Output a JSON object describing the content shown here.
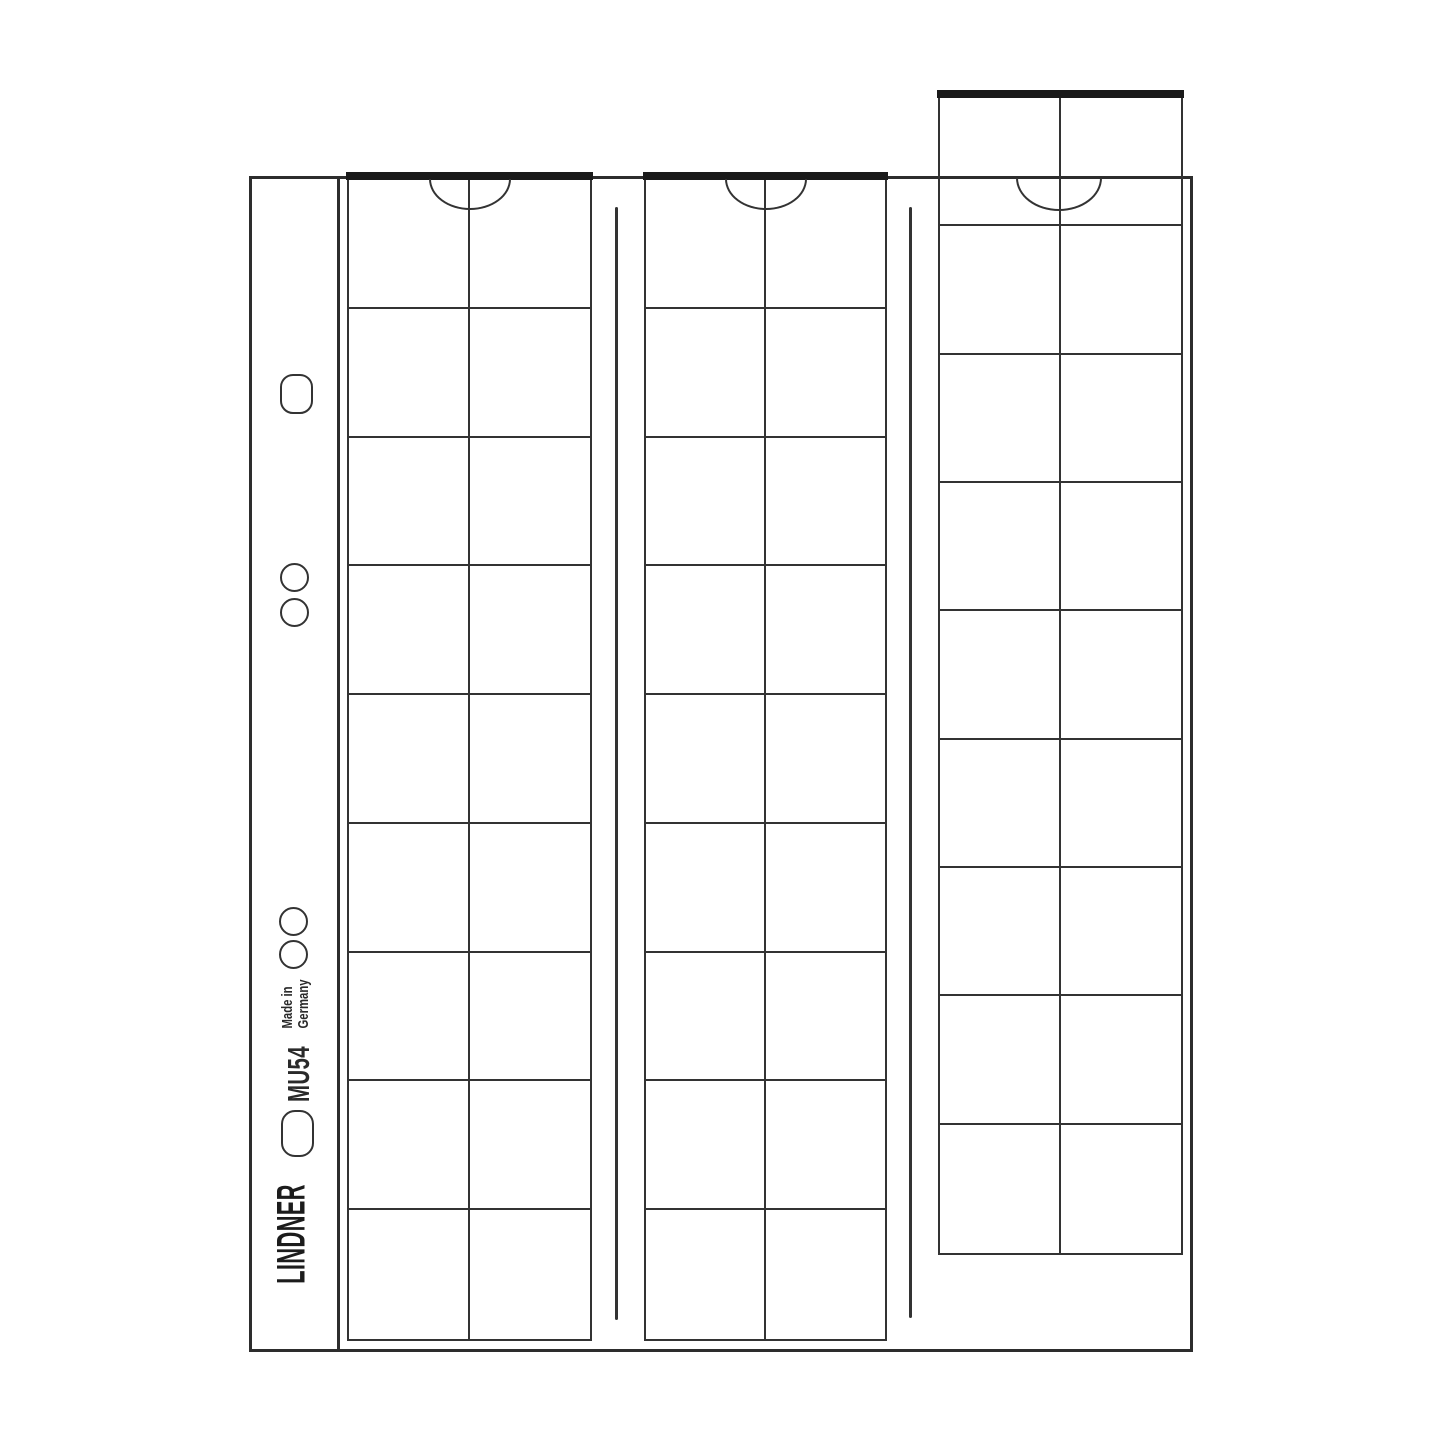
{
  "artwork": {
    "type": "coin-album-sheet-illustration",
    "brand": "LINDNER",
    "model": "MU54",
    "origin": {
      "line1": "Made in",
      "line2": "Germany"
    },
    "sheet": {
      "strips": 3,
      "columns_per_strip": 2,
      "rows_per_strip": 9,
      "total_pockets": 54
    },
    "colors": {
      "background": "#ffffff",
      "line": "#333333",
      "page_border": "#2d2d2d",
      "strip_top_bar": "#1a1a1a",
      "text": "#222222"
    }
  }
}
